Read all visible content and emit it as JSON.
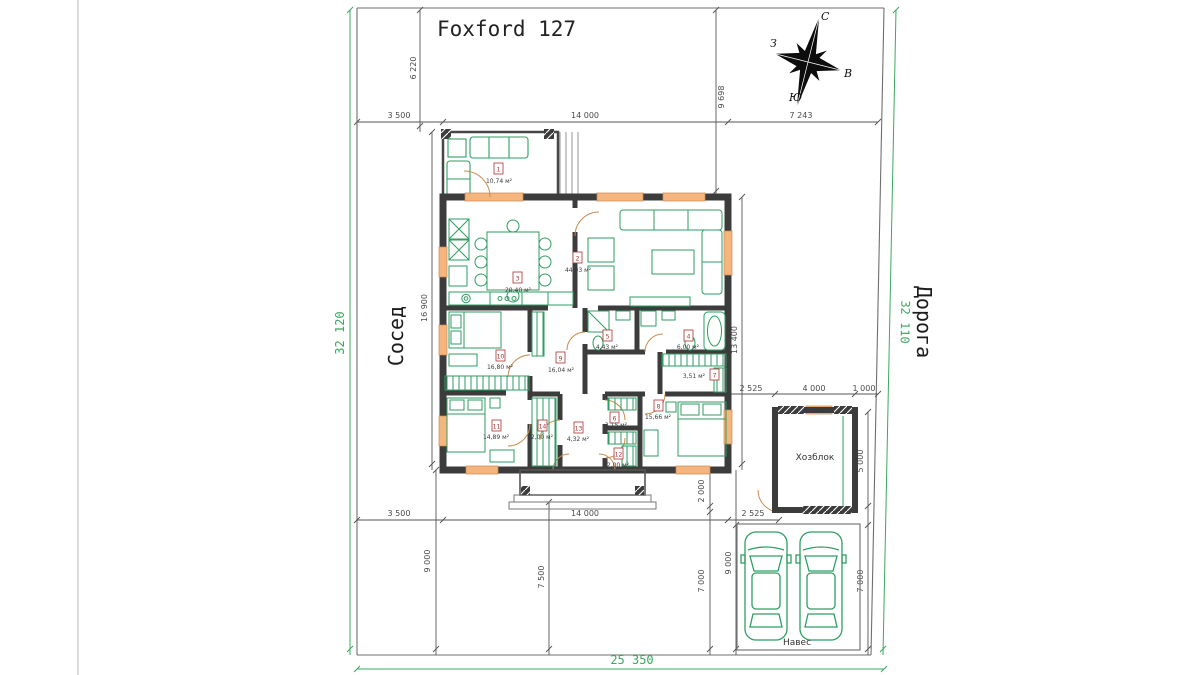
{
  "title": "Foxford 127",
  "labels": {
    "neighbor": "Сосед",
    "road": "Дорога",
    "shed": "Хозблок",
    "carport": "Навес"
  },
  "compass": {
    "north": "С",
    "south": "Ю",
    "west": "З",
    "east": "В"
  },
  "site_dims": {
    "left": "32 120",
    "right": "32 110",
    "bottom": "25 350"
  },
  "dims": {
    "offset_left_top": "3 500",
    "house_width": "14 000",
    "offset_right_top": "7 243",
    "terrace_setback": "6 220",
    "house_setback": "9 698",
    "house_left_height": "16 900",
    "house_right_height": "13 400",
    "shed_gap": "2 525",
    "shed_width": "4 000",
    "shed_right_offset": "1 000",
    "shed_height": "5 000",
    "shed_bottom_gap": "2 000",
    "offset_left_bottom": "3 500",
    "house_width_bottom": "14 000",
    "carport_gap": "2 525",
    "backyard_depth": "9 000",
    "porch_to_boundary": "7 500",
    "carport_left_depth": "7 000",
    "carport_height": "9 000",
    "carport_right_depth": "7 000"
  },
  "rooms": [
    {
      "num": "1",
      "area": "10,74 м²"
    },
    {
      "num": "2",
      "area": "44,93 м²"
    },
    {
      "num": "3",
      "area": "20,40 м²"
    },
    {
      "num": "4",
      "area": "6,00 м²"
    },
    {
      "num": "5",
      "area": "4,43 м²"
    },
    {
      "num": "6",
      "area": "3,15 м²"
    },
    {
      "num": "7",
      "area": "3,51 м²"
    },
    {
      "num": "8",
      "area": "15,66 м²"
    },
    {
      "num": "9",
      "area": "16,04 м²"
    },
    {
      "num": "10",
      "area": "16,80 м²"
    },
    {
      "num": "11",
      "area": "14,89 м²"
    },
    {
      "num": "12",
      "area": "2,00 м²"
    },
    {
      "num": "13",
      "area": "4,32 м²"
    },
    {
      "num": "14",
      "area": "2,00 м²"
    }
  ],
  "colors": {
    "furniture_green": "#2f9e63",
    "dimension_green": "#3aa85f",
    "wall_dark": "#3c3c3c",
    "window_orange": "#f5b57e",
    "room_tag_red": "#b03030"
  }
}
